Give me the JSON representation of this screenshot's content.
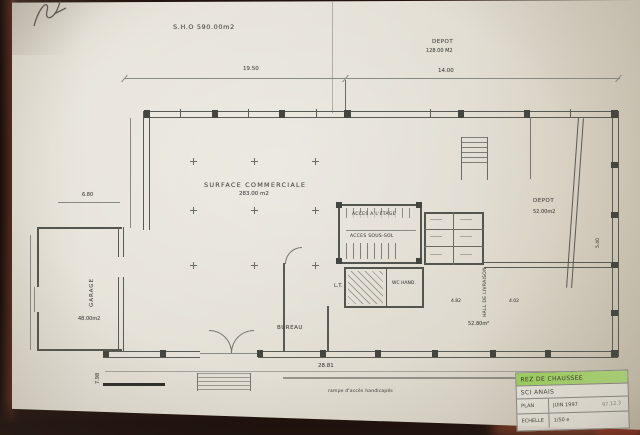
{
  "photo": {
    "paper_color": "#e4e0d6",
    "background_color": "#23130e",
    "highlight_color": "#9ed45f",
    "line_color": "#55554f"
  },
  "plan": {
    "sho_label": "S.H.O  590.00m2",
    "surface_commerciale": {
      "name": "SURFACE COMMERCIALE",
      "area": "283.00 m2"
    },
    "depot_top": {
      "name": "DEPOT",
      "area": "128.00 M2"
    },
    "depot_right": {
      "name": "DEPOT",
      "area": "52.00m2"
    },
    "garage": {
      "name": "GARAGE",
      "area": "48.00m2"
    },
    "bureau": {
      "name": "BUREAU"
    },
    "hall_livraison": {
      "name": "HALL DE LIVRAISON",
      "area": "52.80m²"
    },
    "wc_hand": "WC HAND.",
    "local_technique": "L.T.",
    "acces_etage": "ACCES A L'ETAGE",
    "acces_sous_sol": "ACCES SOUS-SOL",
    "rampe_note": "rampe d'accès handicapés"
  },
  "dimensions": {
    "top_left": "19.50",
    "top_right": "14.00",
    "garage_top": "6.80",
    "bottom": "28.81",
    "bottom_left": "7.98",
    "hall_w1": "4.82",
    "hall_w2": "4.02",
    "right_v": "5.40"
  },
  "titleblock": {
    "phase": "REZ DE CHAUSSEE",
    "client": "SCI ANAIS",
    "row1_label": "PLAN",
    "row1_value": "JUIN 1997",
    "row1_note": "97.12.3",
    "row2_label": "ECHELLE",
    "row2_value": "1/50 e"
  }
}
